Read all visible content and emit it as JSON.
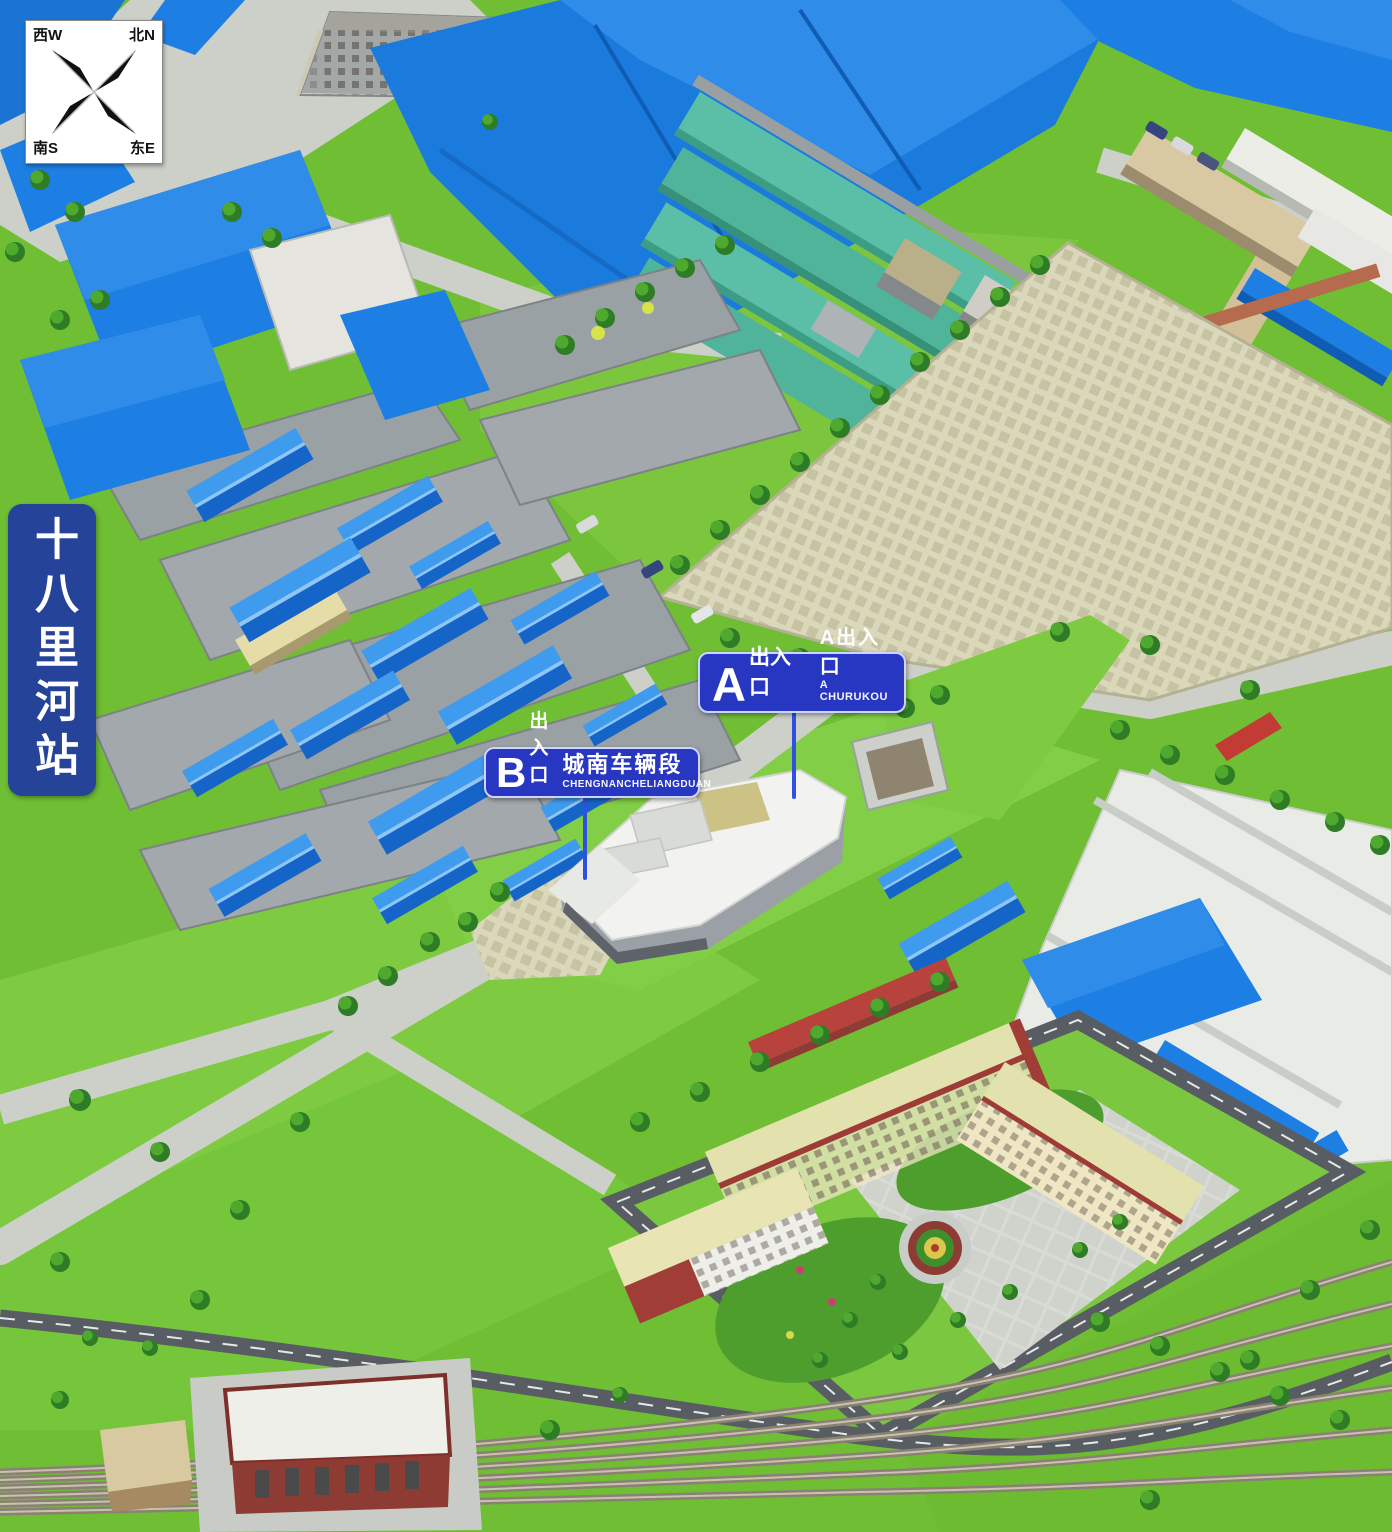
{
  "map": {
    "station_name": "十八里河站",
    "compass": {
      "nw": "西W",
      "ne": "北N",
      "sw": "南S",
      "se": "东E"
    },
    "signs": {
      "a": {
        "letter": "A",
        "letter_suffix": "出入口",
        "name_cn": "A出入口",
        "name_en": "A CHURUKOU"
      },
      "b": {
        "letter": "B",
        "letter_suffix": "出入口",
        "name_cn": "城南车辆段",
        "name_en": "CHENGNANCHELIANGDUAN"
      }
    },
    "colors": {
      "sign_blue": "#2837C2",
      "plate_blue": "#26439A",
      "leader_blue": "#3050E0",
      "roof_blue": "#1D7FE3",
      "roof_teal": "#56BDA2",
      "grass_green": "#6FBE33",
      "lot_beige": "#DAD7BB",
      "road_dark": "#575D63",
      "paving_light": "#CDD0C8"
    }
  }
}
